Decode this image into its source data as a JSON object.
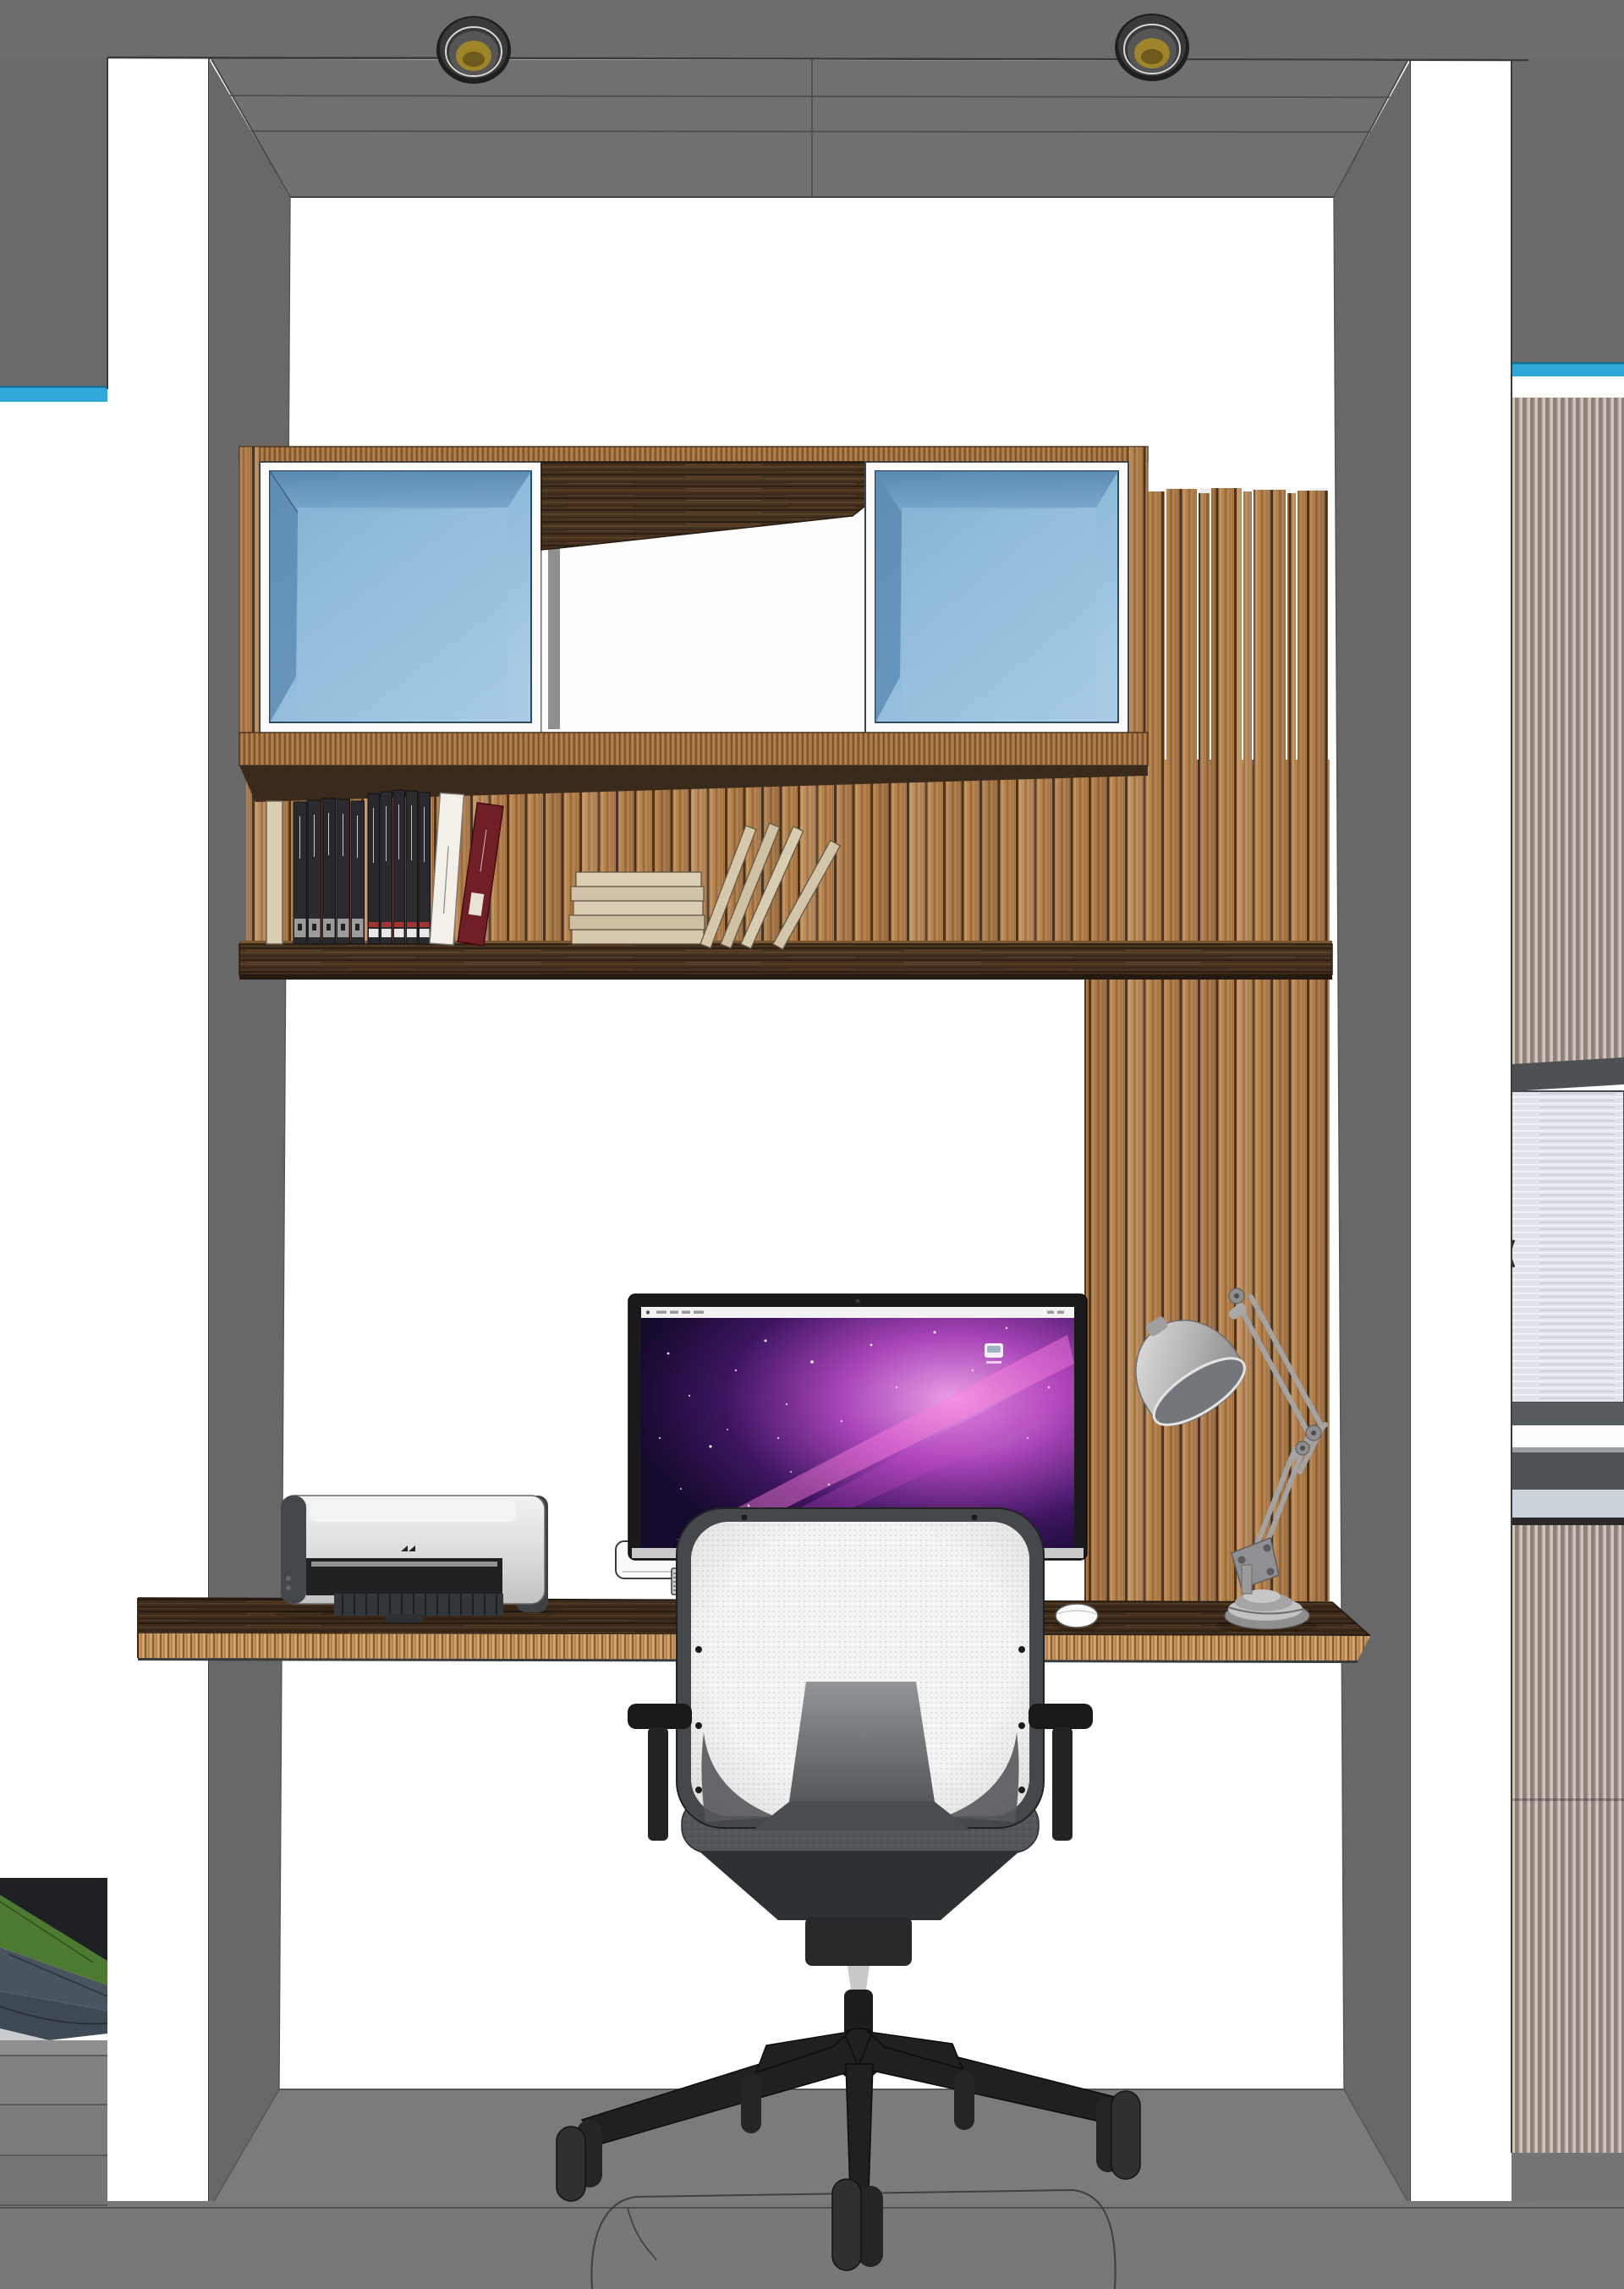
{
  "scene": {
    "type": "3d-interior-render",
    "view": "front elevation of a built-in home-office alcove",
    "objects": [
      "ceiling-soffit",
      "ceiling-spotlight-left",
      "ceiling-spotlight-right",
      "left-column",
      "right-column",
      "alcove-left-wall",
      "alcove-right-wall",
      "accent-stripe-left",
      "accent-stripe-right",
      "wall-cabinet",
      "glass-door-left",
      "glass-door-right",
      "open-niche-middle",
      "wood-slat-wall",
      "slat-fins-right",
      "book-shelf",
      "black-book-set-1",
      "black-book-set-2",
      "white-book",
      "red-book",
      "cream-book",
      "flat-book-stack",
      "leaning-books",
      "desk-top",
      "printer",
      "apple-keyboard",
      "small-device",
      "imac",
      "imac-screen-wallpaper",
      "desktop-drive-icon",
      "apple-mouse",
      "desk-lamp",
      "office-chair",
      "chair-mesh-back",
      "chair-seat",
      "chair-base",
      "floor",
      "floor-mat-outline",
      "stair-steps",
      "garden-view",
      "frosted-cabinet-right",
      "striped-screen-right"
    ],
    "counts": {
      "ceiling_lights": 2,
      "glass_doors": 2,
      "chair_casters": 5,
      "flat_stacked_books": 5,
      "leaning_books": 4
    }
  },
  "palette": {
    "wall_gray": "#6d6d6d",
    "soffit_gray": "#707070",
    "side_wall_gray": "#686868",
    "accent_cyan": "#2fa8dc",
    "floor_gray": "#787878",
    "floor_front_gray": "#717171",
    "slat_wood": "#b8854f",
    "walnut_dark": "#47321f",
    "plywood_edge": "#c99a63",
    "glass_blue": "#7fb2d8",
    "frosted_panel": "#dfe3ea",
    "stripe_dark": "#8e817a",
    "stripe_light": "#cfc5be",
    "mesh_white": "#f3f3f3",
    "chair_dark": "#232527",
    "screen_magenta": "#e24fd0",
    "screen_deep": "#140a2c",
    "lamp_steel": "#b9b9b9",
    "book_black": "#2a2a2e",
    "book_cream": "#d6c9ad",
    "book_red": "#701f26"
  }
}
